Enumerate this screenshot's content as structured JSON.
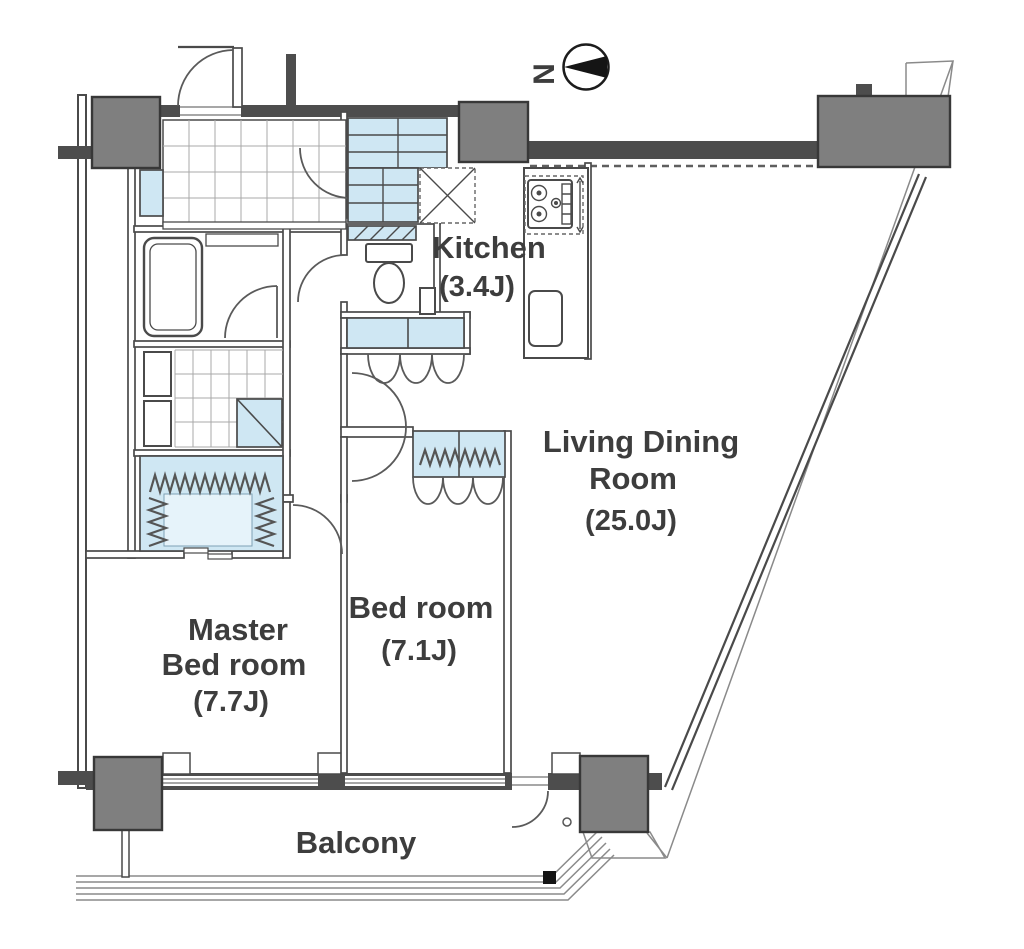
{
  "plan": {
    "rooms": {
      "kitchen": {
        "name": "Kitchen",
        "area": "(3.4J)"
      },
      "living_dining": {
        "name_line1": "Living Dining",
        "name_line2": "Room",
        "area": "(25.0J)"
      },
      "bedroom": {
        "name": "Bed room",
        "area": "(7.1J)"
      },
      "master_bedroom": {
        "name_line1": "Master",
        "name_line2": "Bed room",
        "area": "(7.7J)"
      },
      "balcony": {
        "name": "Balcony"
      }
    },
    "compass": {
      "north_label": "N"
    }
  },
  "colors": {
    "wall": "#4d4d4d",
    "column": "#7f7f7f",
    "column-border": "#383838",
    "line": "#4a4a4a",
    "thin": "#8a8a8a",
    "blue": "#cfe7f3",
    "blue-light": "#e6f3fa",
    "grid": "#a8a8a8",
    "text": "#3d3d3d",
    "bg": "#ffffff",
    "black": "#141414"
  }
}
